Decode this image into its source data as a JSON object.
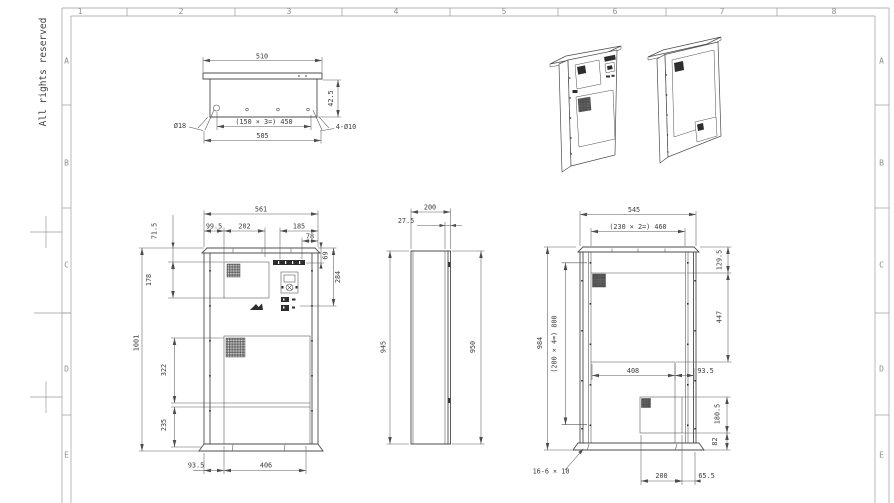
{
  "sheet": {
    "copyright": "All rights reserved",
    "cols": [
      "1",
      "2",
      "3",
      "4",
      "5",
      "6",
      "7",
      "8"
    ],
    "rows": [
      "A",
      "B",
      "C",
      "D",
      "E"
    ]
  },
  "colors": {
    "object_line": "#4c4c4c",
    "dim_line": "#5a5a5a",
    "frame": "#9a9a9a",
    "background": "#ffffff",
    "vent_fill": "#2e2e2e"
  },
  "top_view": {
    "width_top": "510",
    "flange_height": "42.5",
    "corner_hole": "Ø18",
    "hole_pitch": "(150 × 3=) 450",
    "mount_holes": "4-Ø10",
    "width_base": "505"
  },
  "front_view": {
    "width": "561",
    "seg_left": "99.5",
    "seg_door": "202",
    "seg_panel": "185",
    "seg_small": "78",
    "top_offset": "71.5",
    "door_height": "178",
    "louver_height": "69",
    "panel_height": "284",
    "height": "1001",
    "mid_height": "322",
    "lower_height": "235",
    "bottom_left": "93.5",
    "bottom_door": "406"
  },
  "side_view": {
    "depth": "200",
    "door_thickness": "27.5",
    "height_body": "945",
    "height_door": "950"
  },
  "back_view": {
    "width": "545",
    "hole_pitch_h": "(230 × 2=) 460",
    "top_offset": "129.5",
    "opening_height": "447",
    "height": "984",
    "hole_pitch_v": "(200 × 4=) 800",
    "opening_width": "408",
    "opening_right": "93.5",
    "panel_height": "180.5",
    "panel_bottom": "82",
    "slots": "16-6 × 10",
    "bottom_width": "200",
    "bottom_right": "65.5"
  }
}
